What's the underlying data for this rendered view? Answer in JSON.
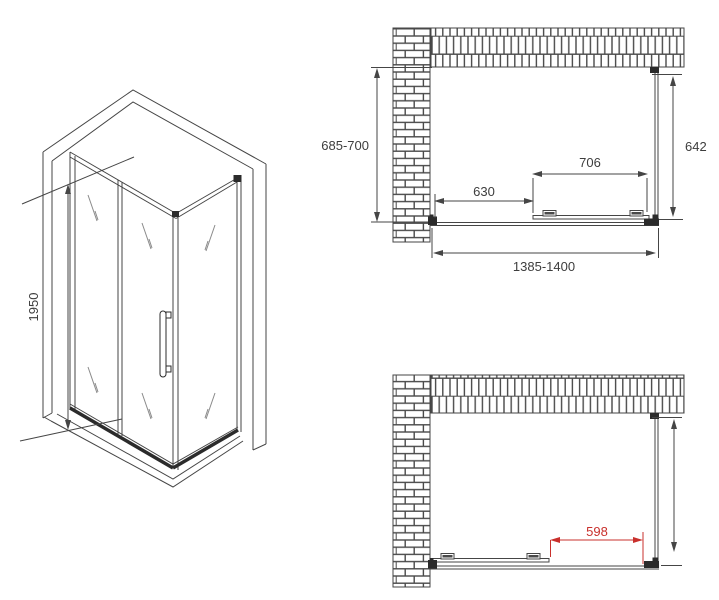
{
  "colors": {
    "line": "#454545",
    "brick_mortar": "#4a4a4a",
    "accent_red": "#c9302c",
    "text": "#3d3d3d"
  },
  "isometric_view": {
    "height_label": "1950"
  },
  "top_plan_view": {
    "depth_label": "685-700",
    "inner_depth_label": "642",
    "door_width_label": "706",
    "side_width_label": "630",
    "overall_width_label": "1385-1400"
  },
  "bottom_plan_view": {
    "opening_width_label": "598"
  }
}
